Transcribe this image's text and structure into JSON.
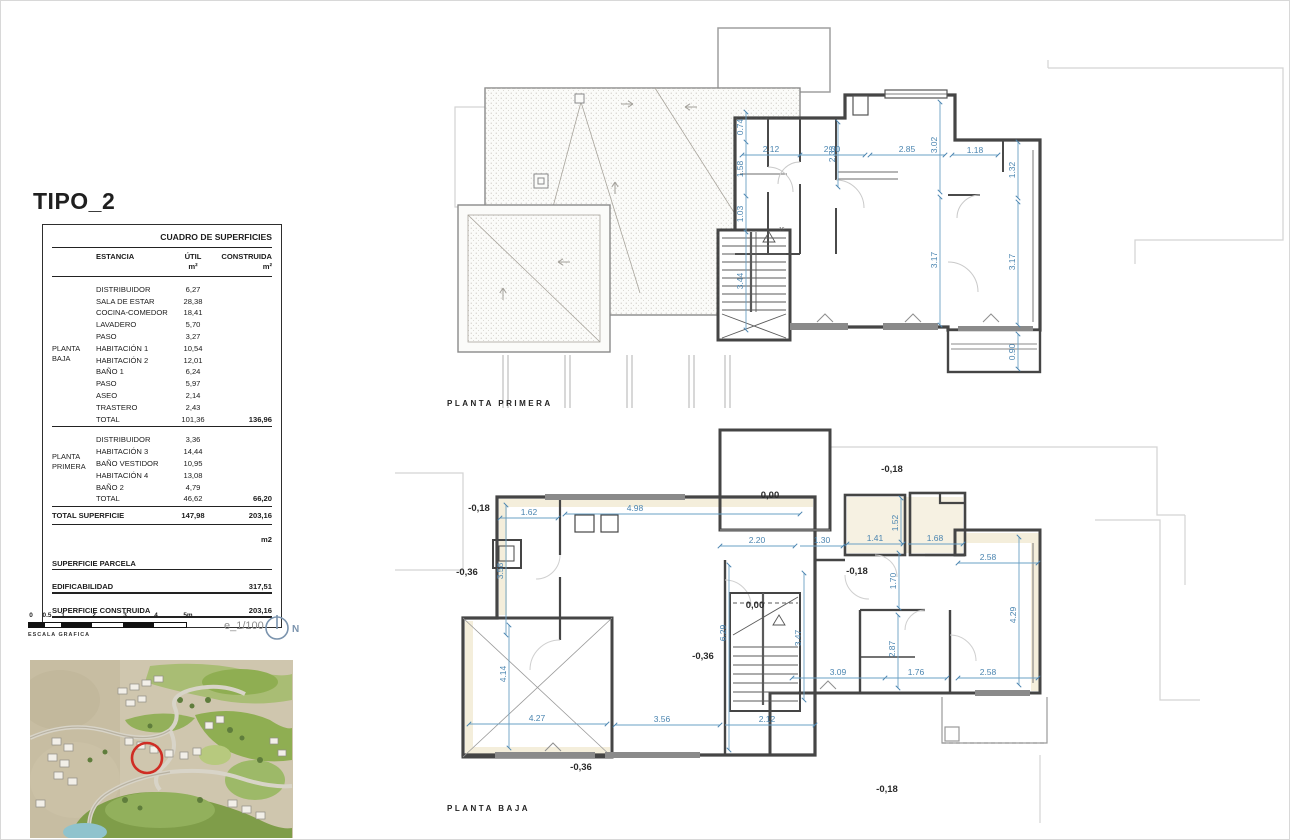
{
  "sheet": {
    "title": "TIPO_2"
  },
  "table": {
    "title": "CUADRO DE SUPERFICIES",
    "columns": {
      "estancia": "ESTANCIA",
      "util": "ÚTIL",
      "construida": "CONSTRUIDA",
      "unit": "m²"
    },
    "groups": [
      {
        "name": "PLANTA BAJA",
        "rows": [
          [
            "DISTRIBUIDOR",
            "6,27"
          ],
          [
            "SALA DE ESTAR",
            "28,38"
          ],
          [
            "COCINA-COMEDOR",
            "18,41"
          ],
          [
            "LAVADERO",
            "5,70"
          ],
          [
            "PASO",
            "3,27"
          ],
          [
            "HABITACIÓN 1",
            "10,54"
          ],
          [
            "HABITACIÓN 2",
            "12,01"
          ],
          [
            "BAÑO 1",
            "6,24"
          ],
          [
            "PASO",
            "5,97"
          ],
          [
            "ASEO",
            "2,14"
          ],
          [
            "TRASTERO",
            "2,43"
          ]
        ],
        "total_label": "TOTAL",
        "total_util": "101,36",
        "total_construida": "136,96"
      },
      {
        "name": "PLANTA PRIMERA",
        "rows": [
          [
            "DISTRIBUIDOR",
            "3,36"
          ],
          [
            "HABITACIÓN 3",
            "14,44"
          ],
          [
            "BAÑO VESTIDOR",
            "10,95"
          ],
          [
            "HABITACIÓN 4",
            "13,08"
          ],
          [
            "BAÑO 2",
            "4,79"
          ]
        ],
        "total_label": "TOTAL",
        "total_util": "46,62",
        "total_construida": "66,20"
      }
    ],
    "total_row": {
      "label": "TOTAL SUPERFICIE",
      "util": "147,98",
      "construida": "203,16"
    },
    "m2_label": "m2",
    "footer": [
      {
        "label": "SUPERFICIE PARCELA",
        "value": ""
      },
      {
        "label": "EDIFICABILIDAD",
        "value": "317,51"
      },
      {
        "label": "SUPERFICIE CONSTRUIDA",
        "value": "203,16"
      }
    ]
  },
  "scalebar": {
    "ticks": [
      "0",
      "0.5",
      "1",
      "2",
      "3",
      "4",
      "5m"
    ],
    "caption": "ESCALA GRAFICA",
    "ratio": "e_1/100",
    "north": "N"
  },
  "plans": {
    "primera": {
      "label": "PLANTA PRIMERA",
      "stair_label": "16",
      "dims": [
        "2.12",
        "2.00",
        "2.85",
        "1.18",
        "0.74",
        "1.58",
        "1.03",
        "3.44",
        "2.32",
        "3.02",
        "3.17",
        "1.32",
        "3.17",
        "0.90"
      ]
    },
    "baja": {
      "label": "PLANTA BAJA",
      "dims": [
        "1.62",
        "4.98",
        "3.58",
        "2.20",
        "1.30",
        "1.41",
        "1.68",
        "1.52",
        "1.70",
        "2.58",
        "4.29",
        "2.58",
        "6.29",
        "3.47",
        "2.87",
        "3.09",
        "1.76",
        "4.14",
        "4.27",
        "3.56",
        "2.12"
      ],
      "levels": [
        "0,00",
        "-0,18",
        "-0,36",
        "-0,18",
        "-0,18",
        "0,00",
        "-0,36",
        "-0,36",
        "-0,18"
      ]
    }
  }
}
